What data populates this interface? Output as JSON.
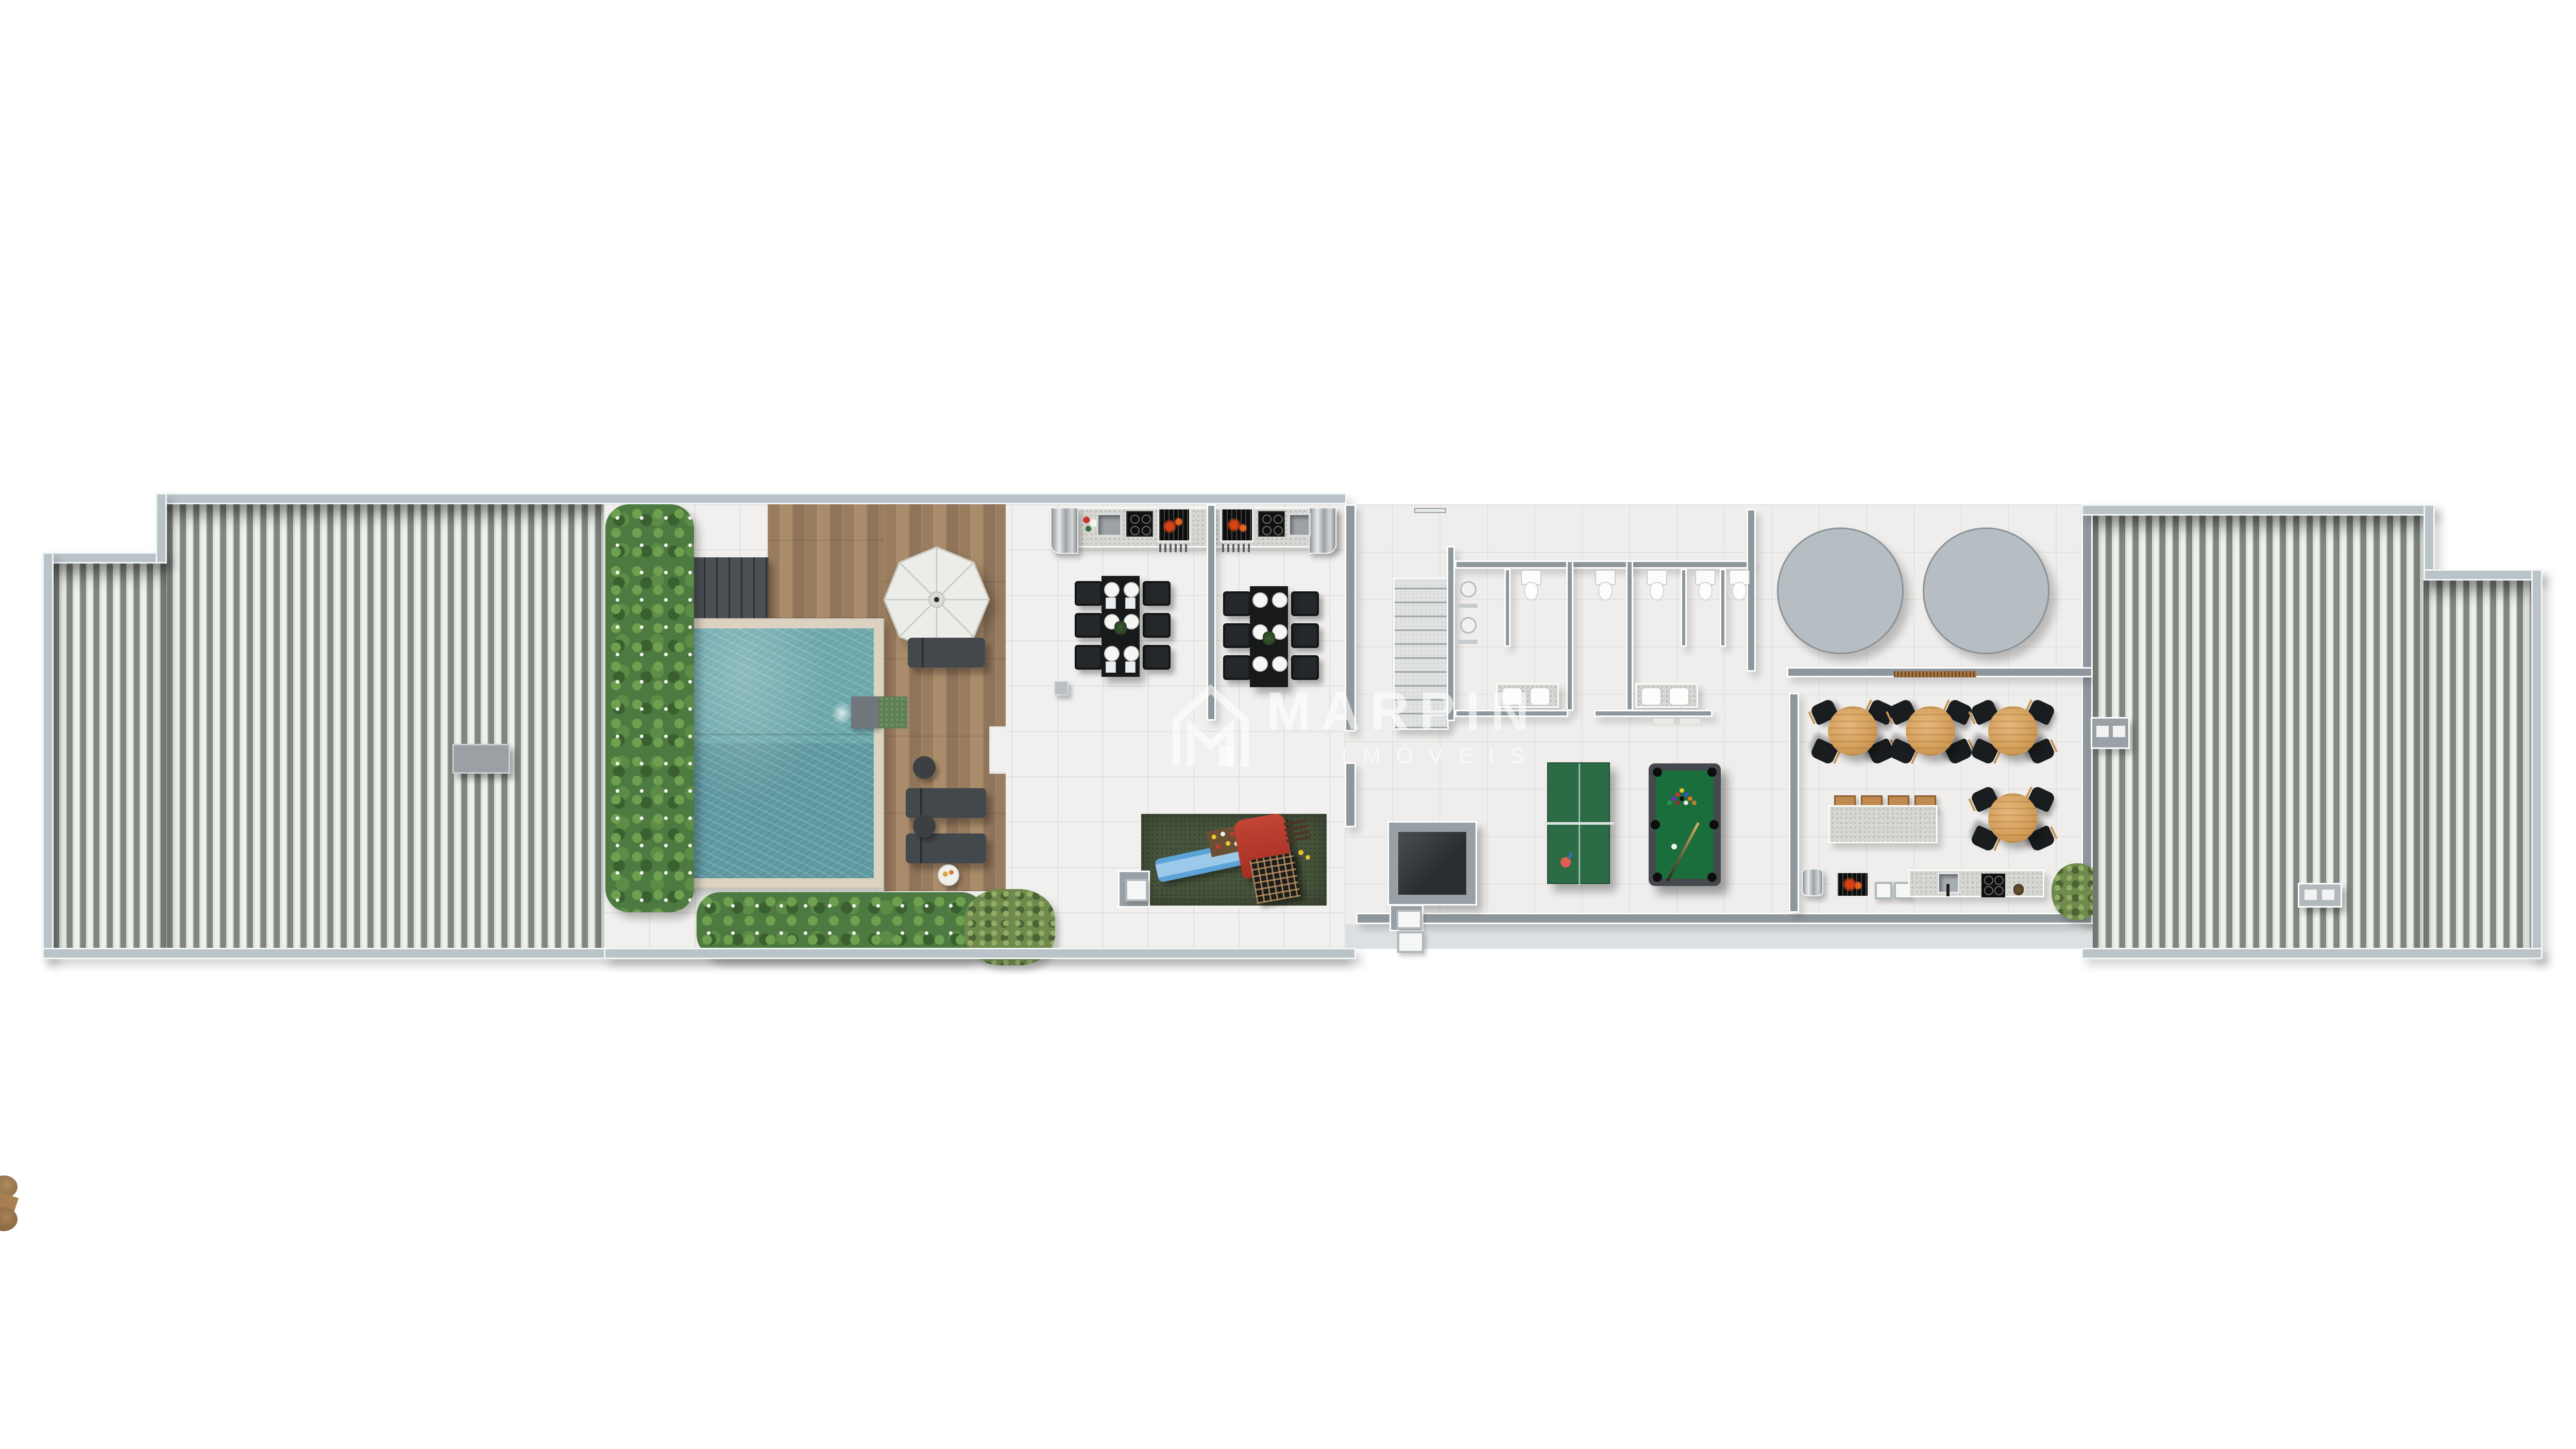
{
  "watermark": {
    "brand": "MARPIN",
    "subtitle": "IMÓVEIS"
  },
  "scene": {
    "type": "architectural floor plan render",
    "view": "top-down",
    "background": "#ffffff"
  },
  "palette": {
    "outer_wall": "#b9c3c8",
    "inner_wall": "#8e979c",
    "roof_stripe_dark": "#7f877f",
    "roof_stripe_light": "#eef1ee",
    "tile_floor": "#f1f0ee",
    "deck_wood": "#a28363",
    "pool_water": "#64a0a6",
    "pool_coping": "#dbd2c1",
    "hedge_green": "#4d7a40",
    "turf_green": "#47543c",
    "lounger_gray": "#43484c",
    "umbrella_white": "#ecece8",
    "terrace_table_black": "#17191b",
    "round_table_wood": "#d9a765",
    "pool_table_felt": "#1a6e3c",
    "ping_pong_green": "#2b6b45",
    "playset_red": "#b5392b",
    "slide_blue": "#5ba3d8",
    "grill_fire": "#d84315",
    "reservoir_gray": "#b7bec3"
  },
  "inventory": {
    "pools": 1,
    "umbrellas": 1,
    "loungers": 3,
    "side_tables": 3,
    "bbq_stations": 2,
    "terrace_tables": 2,
    "chairs_per_terrace_table": 6,
    "playgrounds": 1,
    "stairs": 1,
    "showers": 2,
    "toilets": 5,
    "bathroom_sinks": 4,
    "reservoir_circles": 2,
    "ping_pong_tables": 1,
    "billiard_tables": 1,
    "party_round_tables": 4,
    "chairs_per_round_table": 4,
    "bar_stools": 4,
    "trees": 1
  }
}
